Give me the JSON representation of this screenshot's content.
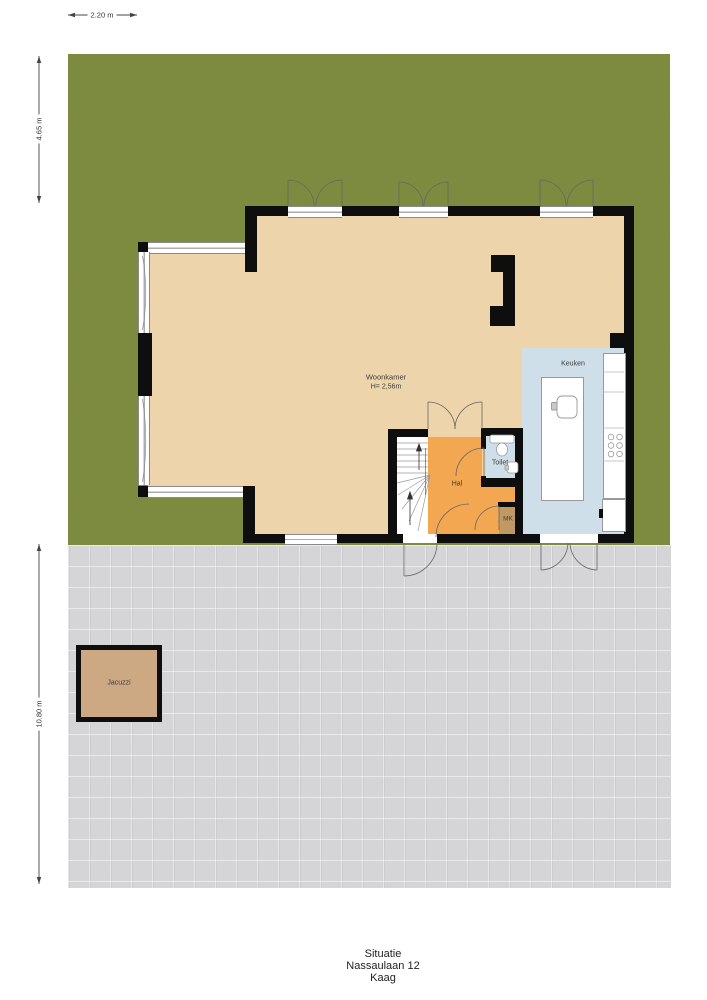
{
  "labels": {
    "woonkamer": "Woonkamer",
    "woonkamer_height": "H= 2,56m",
    "keuken": "Keuken",
    "hal": "Hal",
    "toilet": "Toilet",
    "mk": "MK",
    "jacuzzi": "Jacuzzi"
  },
  "dimensions": {
    "top_width": "2.20 m",
    "left_upper_height": "4.65 m",
    "left_lower_height": "10.80 m"
  },
  "title": {
    "line1": "Situatie",
    "line2": "Nassaulaan 12",
    "line3": "Kaag"
  },
  "colors": {
    "grass": "#7b8b3d",
    "pavement": "#d6d6d8",
    "floor": "#eed4ab",
    "kitchen": "#cfdfe9",
    "hall": "#f2a750",
    "mk_closet": "#c09a62",
    "jacuzzi_fill": "#cda983",
    "wall": "#0e0e0e"
  }
}
